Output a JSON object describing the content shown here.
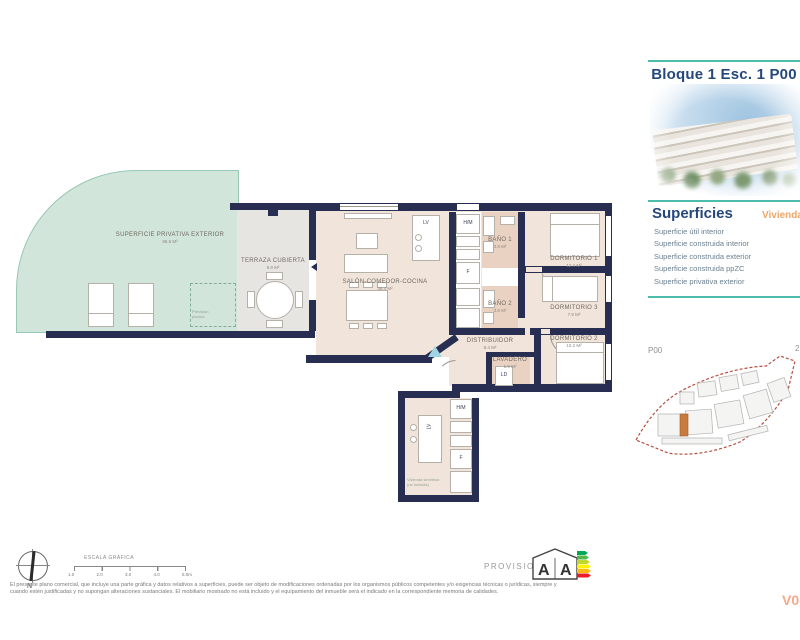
{
  "colors": {
    "wall_navy": "#272e52",
    "accent_teal": "#4cbcab",
    "heading_navy": "#25487c",
    "vivienda_orange": "#eda766",
    "site_boundary_red": "#b5503f",
    "highlight_unit_orange": "#c97a3f",
    "version_salmon": "#f3a98b",
    "exterior_green": "#d2e5da",
    "interior_beige": "#f1e4da"
  },
  "header": {
    "title": "Bloque 1 Esc. 1 P00 A"
  },
  "superficies": {
    "heading": "Superficies",
    "unit_label": "Vivienda",
    "items": [
      "Superficie útil interior",
      "Superficie construida interior",
      "Superficie construida exterior",
      "Superficie construida ppZC",
      "Superficie privativa exterior"
    ]
  },
  "site_plan": {
    "level_label": "P00",
    "corner_label": "2"
  },
  "plan": {
    "rooms": {
      "exterior": {
        "name": "SUPERFICIE PRIVATIVA EXTERIOR",
        "area": "96.6 m²"
      },
      "terraza": {
        "name": "TERRAZA CUBIERTA",
        "area": "9.9 m²"
      },
      "salon": {
        "name": "SALÓN-COMEDOR-COCINA",
        "area": "38.4 m²"
      },
      "bano1": {
        "name": "BAÑO 1",
        "area": "3.9 m²"
      },
      "bano2": {
        "name": "BAÑO 2",
        "area": "3.6 m²"
      },
      "dorm1": {
        "name": "DORMITORIO 1",
        "area": "12.4 m²"
      },
      "dorm2": {
        "name": "DORMITORIO 2",
        "area": "10.2 m²"
      },
      "dorm3": {
        "name": "DORMITORIO 3",
        "area": "7.9 m²"
      },
      "distribuidor": {
        "name": "DISTRIBUIDOR",
        "area": "8.4 m²"
      },
      "lavadero": {
        "name": "LAVADERO",
        "area": "1.9 m²"
      }
    },
    "appliances": {
      "lv": "LV",
      "hm": "H/M",
      "f": "F",
      "ld": "LD"
    },
    "notes": {
      "pool": [
        "Previsión",
        "piscina"
      ],
      "adjacent": [
        "Vivienda simétrica",
        "(no incluida)"
      ]
    }
  },
  "footer": {
    "north_label": "N",
    "scale": {
      "label": "ESCALA GRÁFICA",
      "ticks": [
        "1.0",
        "2.0",
        "3.0",
        "4.0",
        "5.0m"
      ]
    },
    "provisional": "PROVISIONAL",
    "energy": {
      "letters": [
        "A",
        "A"
      ]
    },
    "disclaimer": [
      "El presente plano comercial, que incluye una parte gráfica y datos relativos a superficies, puede ser objeto de modificaciones ordenadas por los organismos públicos competentes y/o exigencias técnicas o jurídicas, siempre y",
      "cuando estén justificadas y no supongan alteraciones sustanciales. El mobiliario mostrado no está incluido y el equipamiento del inmueble será el indicado en la correspondiente memoria de calidades."
    ],
    "version": "V0"
  }
}
